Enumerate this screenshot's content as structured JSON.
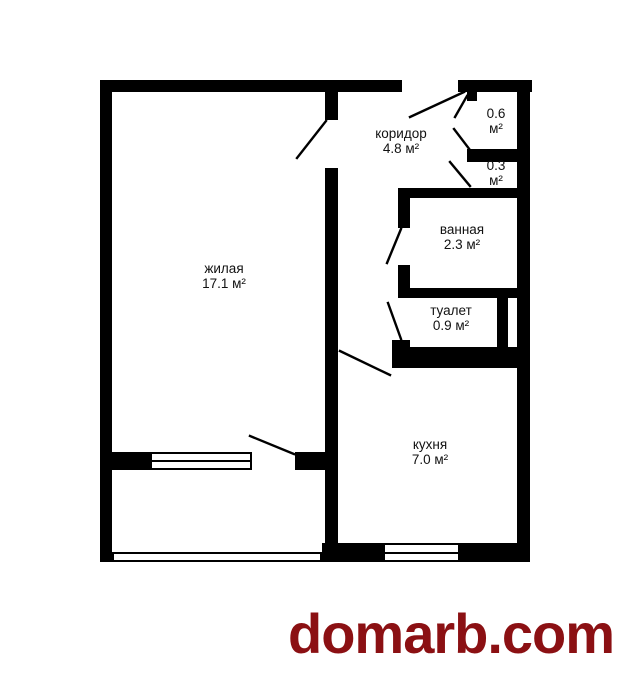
{
  "colors": {
    "wall": "#000000",
    "background": "#ffffff",
    "label_text": "#111111",
    "watermark": "#8B1013"
  },
  "rooms": {
    "living": {
      "line1": "жилая",
      "line2": "17.1 м²"
    },
    "corridor": {
      "line1": "коридор",
      "line2": "4.8 м²"
    },
    "storage_large": {
      "line1": "0.6",
      "line2": "м²"
    },
    "storage_small": {
      "line1": "0.3",
      "line2": "м²"
    },
    "bathroom": {
      "line1": "ванная",
      "line2": "2.3 м²"
    },
    "toilet": {
      "line1": "туалет",
      "line2": "0.9 м²"
    },
    "kitchen": {
      "line1": "кухня",
      "line2": "7.0 м²"
    }
  },
  "watermark": {
    "text": "domarb.com"
  }
}
